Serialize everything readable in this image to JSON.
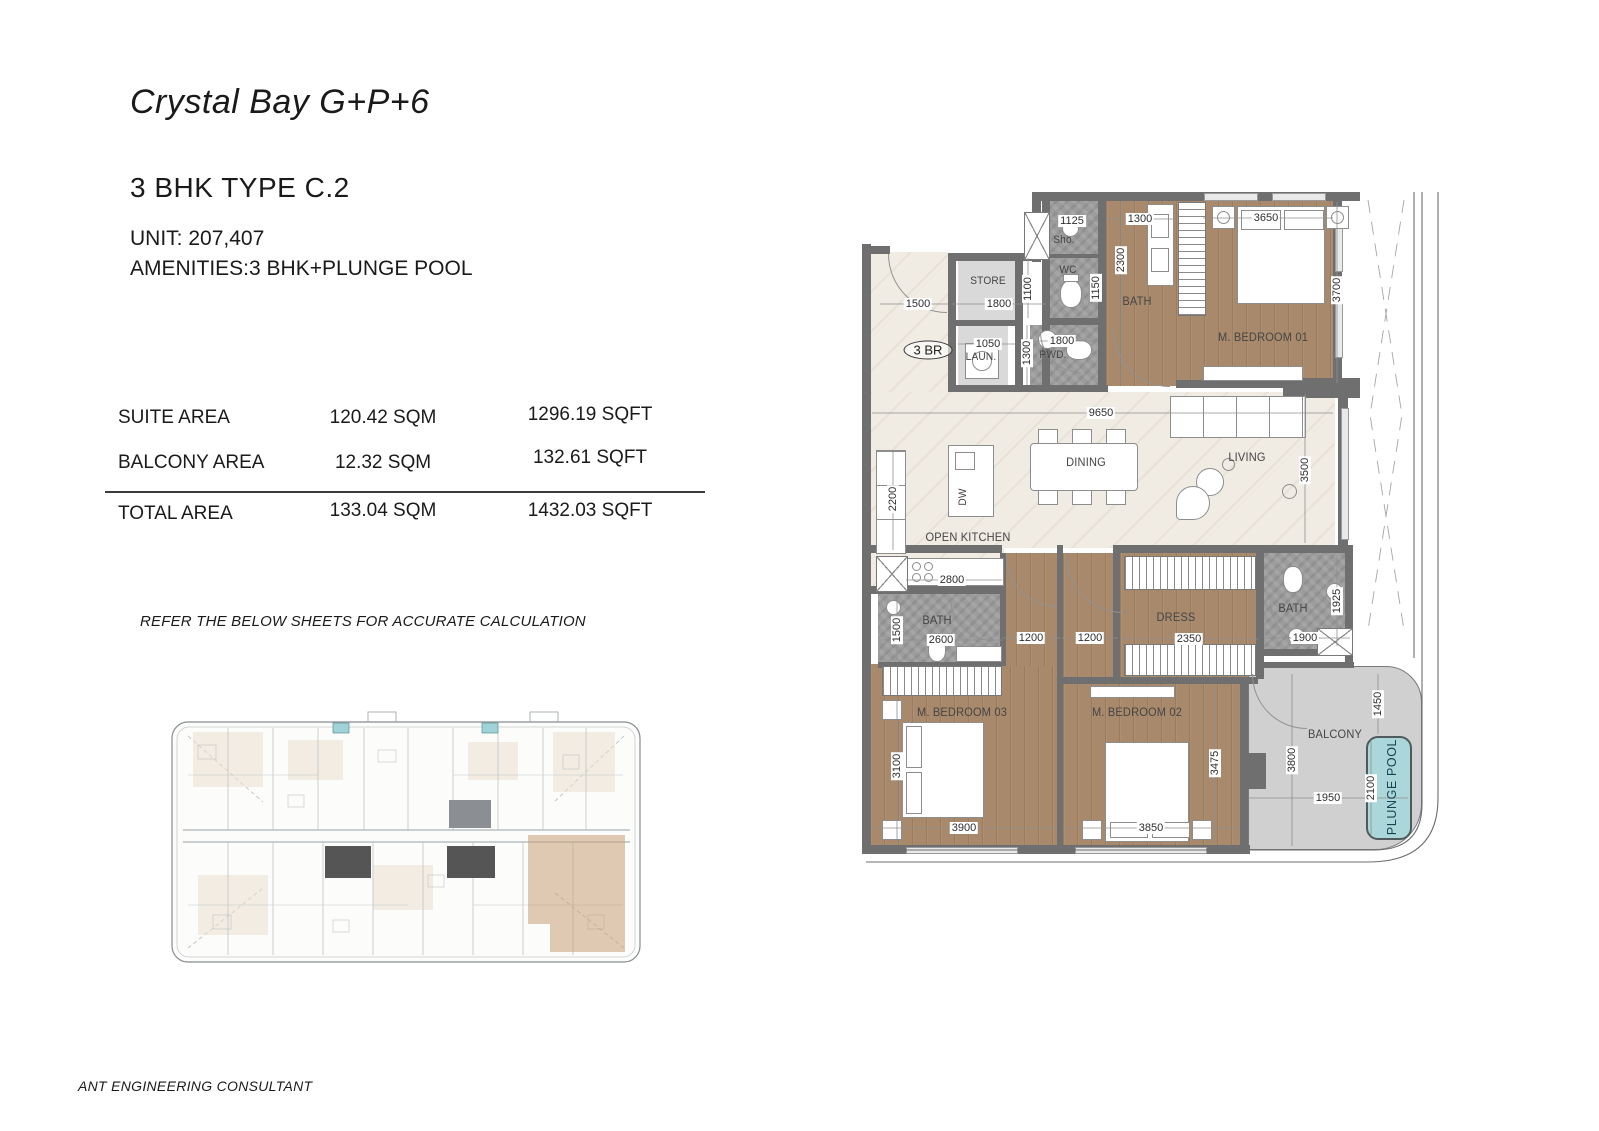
{
  "header": {
    "project_title": "Crystal Bay G+P+6",
    "unit_type": "3 BHK TYPE C.2",
    "unit_line": "UNIT: 207,407",
    "amenities_line": "AMENITIES:3 BHK+PLUNGE POOL"
  },
  "area_table": {
    "rows": [
      {
        "label": "SUITE AREA",
        "sqm": "120.42 SQM",
        "sqft": "1296.19 SQFT"
      },
      {
        "label": "BALCONY AREA",
        "sqm": "12.32 SQM",
        "sqft": "132.61 SQFT"
      },
      {
        "label": "TOTAL AREA",
        "sqm": "133.04 SQM",
        "sqft": "1432.03 SQFT"
      }
    ]
  },
  "note": "REFER THE BELOW SHEETS FOR ACCURATE CALCULATION",
  "footer": "ANT ENGINEERING CONSULTANT",
  "plan": {
    "badge": "3 BR",
    "rooms": {
      "store": "STORE",
      "laundry": "LAUN.",
      "shower": "Sho.",
      "wc": "WC",
      "powder": "PWD.",
      "bath_master": "BATH",
      "bedroom_01": "M. BEDROOM 01",
      "dining": "DINING",
      "living": "LIVING",
      "open_kitchen": "OPEN KITCHEN",
      "bath_03": "BATH",
      "bedroom_03": "M. BEDROOM 03",
      "dress": "DRESS",
      "bath_02": "BATH",
      "bedroom_02": "M. BEDROOM 02",
      "balcony": "BALCONY",
      "plunge_pool": "PLUNGE POOL",
      "dishwasher": "DW"
    },
    "dims": {
      "entry_1500": "1500",
      "store_1800": "1800",
      "store_1100": "1100",
      "sho_1125": "1125",
      "wc_1150": "1150",
      "laun_1050": "1050",
      "pwd_1300": "1300",
      "pwd_1800": "1800",
      "bath1_1300": "1300",
      "bath1_2300": "2300",
      "bed1_3650": "3650",
      "bed1_3700": "3700",
      "living_9650": "9650",
      "kitchen_2200": "2200",
      "living_3500": "3500",
      "kitchen_2800": "2800",
      "bath3_1500": "1500",
      "bath3_2600": "2600",
      "hall_1200_a": "1200",
      "hall_1200_b": "1200",
      "dress_2350": "2350",
      "bath2_1900": "1900",
      "bath2_1925": "1925",
      "bed3_3100": "3100",
      "bed3_3900": "3900",
      "bed2_3475": "3475",
      "bed2_3850": "3850",
      "balcony_3800": "3800",
      "balcony_1950": "1950",
      "balcony_1450": "1450",
      "pool_2100": "2100"
    }
  },
  "colors": {
    "wood_floor": "#a9896b",
    "marble_floor": "#f1ece3",
    "stone_floor": "#9c9c9c",
    "wall": "#6f6f6f",
    "balcony_floor": "#d0d0d0",
    "pool": "#abd7da",
    "keyplan_highlight": "#c79f78"
  }
}
